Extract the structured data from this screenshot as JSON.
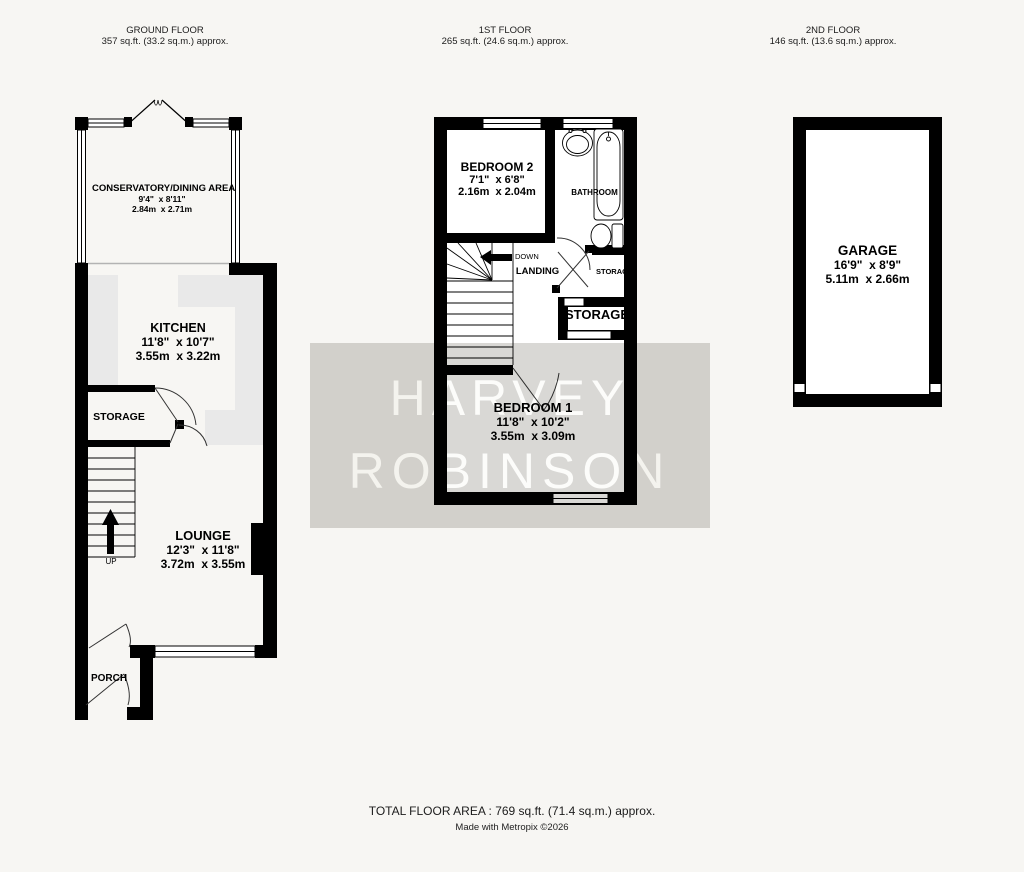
{
  "headers": [
    {
      "title": "GROUND FLOOR",
      "area": "357 sq.ft. (33.2 sq.m.) approx."
    },
    {
      "title": "1ST FLOOR",
      "area": "265 sq.ft. (24.6 sq.m.) approx."
    },
    {
      "title": "2ND FLOOR",
      "area": "146 sq.ft. (13.6 sq.m.) approx."
    }
  ],
  "ground": {
    "conservatory": {
      "name": "CONSERVATORY/DINING AREA",
      "imperial": "9'4\"  x 8'11\"",
      "metric": "2.84m  x 2.71m"
    },
    "kitchen": {
      "name": "KITCHEN",
      "imperial": "11'8\"  x 10'7\"",
      "metric": "3.55m  x 3.22m"
    },
    "lounge": {
      "name": "LOUNGE",
      "imperial": "12'3\"  x 11'8\"",
      "metric": "3.72m  x 3.55m"
    },
    "storage_label": "STORAGE",
    "porch_label": "PORCH",
    "up_label": "UP"
  },
  "first": {
    "bedroom2": {
      "name": "BEDROOM 2",
      "imperial": "7'1\"  x 6'8\"",
      "metric": "2.16m  x 2.04m"
    },
    "bedroom1": {
      "name": "BEDROOM 1",
      "imperial": "11'8\"  x 10'2\"",
      "metric": "3.55m  x 3.09m"
    },
    "bathroom_label": "BATHROOM",
    "landing_label": "LANDING",
    "down_label": "DOWN",
    "storage_small_label": "STORAGE",
    "storage_label": "STORAGE"
  },
  "second": {
    "garage": {
      "name": "GARAGE",
      "imperial": "16'9\"  x 8'9\"",
      "metric": "5.11m  x 2.66m"
    }
  },
  "watermark": {
    "line1": "HARVEY",
    "line2": "ROBINSON"
  },
  "footer": {
    "total": "TOTAL FLOOR AREA : 769 sq.ft. (71.4 sq.m.) approx.",
    "credit": "Made with Metropix ©2026"
  }
}
